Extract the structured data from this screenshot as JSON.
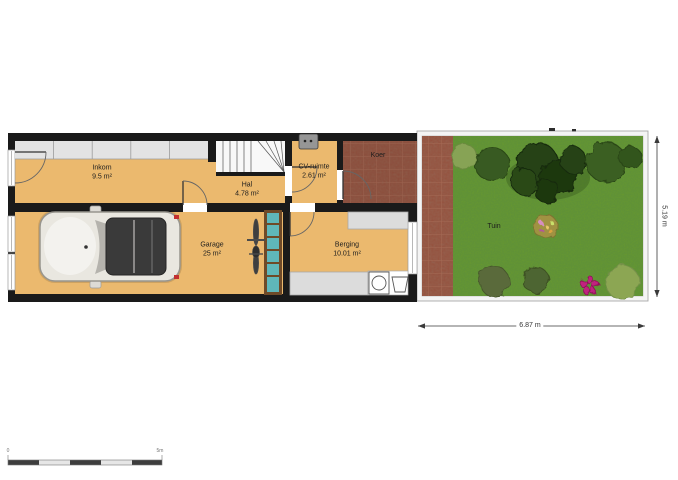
{
  "colors": {
    "floor": "#ebb96e",
    "wall": "#1a1a1a",
    "brick": "#95523f",
    "brick_line": "#ab6a54",
    "grass": "#68992e",
    "counter": "#dcdcdc",
    "teal": "#5fb7ba",
    "wood": "#6f4a28",
    "frame": "#f4f4f4",
    "dim": "#3a3a3a"
  },
  "rooms": {
    "inkom": {
      "name": "Inkom",
      "area": "9.5 m²"
    },
    "hal": {
      "name": "Hal",
      "area": "4.78 m²"
    },
    "cv": {
      "name": "CV-ruimte",
      "area": "2.61 m²"
    },
    "koer": {
      "name": "Koer"
    },
    "garage": {
      "name": "Garage",
      "area": "25 m²"
    },
    "berging": {
      "name": "Berging",
      "area": "10.01 m²"
    },
    "tuin": {
      "name": "Tuin"
    }
  },
  "dimensions": {
    "width": "6.87 m",
    "depth": "5.19 m"
  },
  "scalebar": {
    "start": "0",
    "end": "5m"
  }
}
